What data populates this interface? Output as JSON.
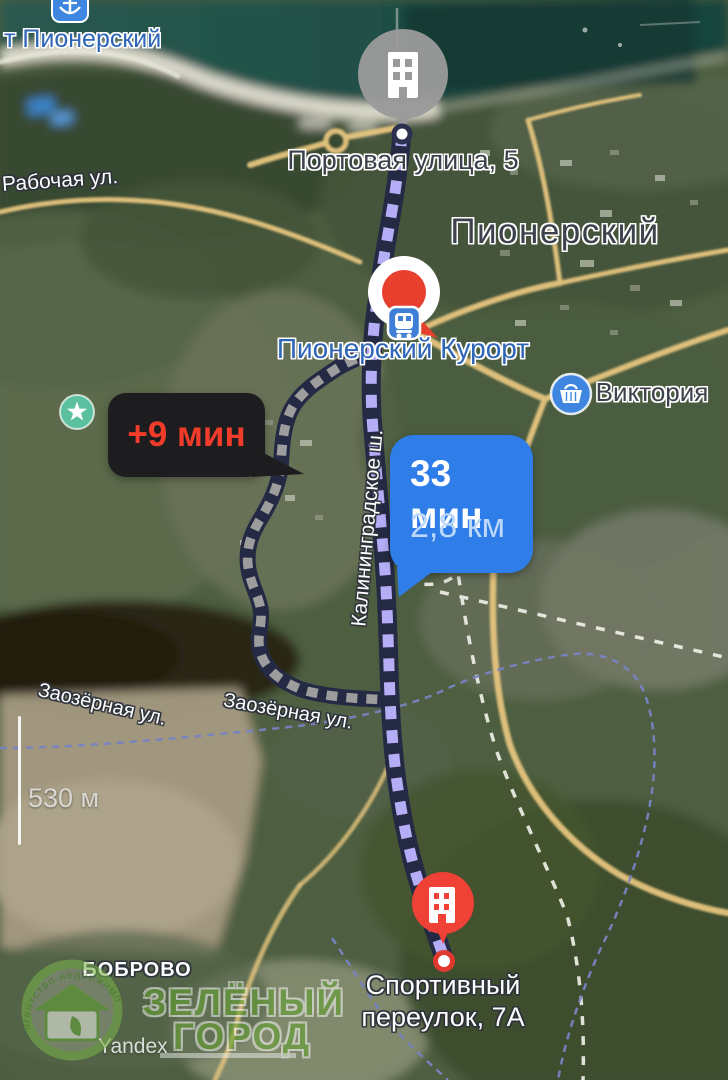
{
  "map": {
    "city": "Пионерский",
    "port": "т Пионерский",
    "village": "БОБРОВО",
    "streets": {
      "rabochaya": "Рабочая ул.",
      "kaliningradskoe": "Калининградское ш.",
      "zaozernaya_left": "Заозёрная ул.",
      "zaozernaya_right": "Заозёрная ул."
    },
    "pois": {
      "station": "Пионерский Курорт",
      "store": "Виктория"
    }
  },
  "route": {
    "origin": {
      "address": "Портовая улица, 5"
    },
    "destination": {
      "address": "Спортивный переулок, 7А"
    },
    "main": {
      "time": "33 мин",
      "distance": "2,8 км",
      "dash_color": "#b5adf5",
      "casing_color": "#252a44",
      "badge_bg": "#2e7de9",
      "badge_time_color": "#ffffff",
      "badge_distance_color": "#bdd8fb"
    },
    "alt": {
      "time_delta": "+9 мин",
      "dash_color": "#9d9d9d",
      "badge_bg": "#1d1d1f",
      "badge_text_color": "#f23c2b"
    }
  },
  "pins": {
    "origin_pin_color": "#9a9a9a",
    "waypoint_pin_color": "#e8402f",
    "destination_pin_color": "#ef4135",
    "station_icon_color": "#3f7fd6",
    "store_icon_color": "#3f86e0",
    "port_icon_color": "#3f86e0",
    "star_icon_color": "#5ac0a0"
  },
  "scale": {
    "label": "530 м"
  },
  "watermarks": {
    "provider": "Yandex",
    "agency": {
      "arc_text": "агентство недвижимости",
      "title_line1": "ЗЕЛЁНЫЙ",
      "title_line2": "ГОРОД"
    }
  }
}
